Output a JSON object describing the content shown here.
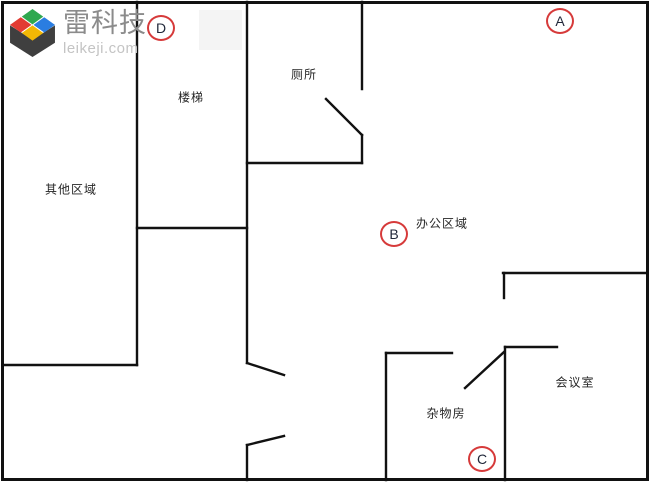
{
  "logo": {
    "title": "雷科技",
    "domain": "leikeji.com",
    "icon": "cube-logo-icon",
    "icon_colors": {
      "green": "#2fa84f",
      "blue": "#2a7de1",
      "red": "#e23c33",
      "yellow": "#f2b705",
      "body": "#3f3f3f"
    },
    "title_color": "#8b8b8b",
    "domain_color": "#c4c4c4"
  },
  "floorplan": {
    "wall_color": "#111111",
    "marker_color": "#d63a3a",
    "rooms": [
      {
        "id": "other-area",
        "label": "其他区域"
      },
      {
        "id": "stairs",
        "label": "楼梯"
      },
      {
        "id": "toilet",
        "label": "厕所"
      },
      {
        "id": "office-area",
        "label": "办公区域"
      },
      {
        "id": "meeting-room",
        "label": "会议室"
      },
      {
        "id": "storage-room",
        "label": "杂物房"
      }
    ],
    "markers": [
      {
        "id": "A",
        "label": "A"
      },
      {
        "id": "B",
        "label": "B"
      },
      {
        "id": "C",
        "label": "C"
      },
      {
        "id": "D",
        "label": "D"
      }
    ]
  }
}
